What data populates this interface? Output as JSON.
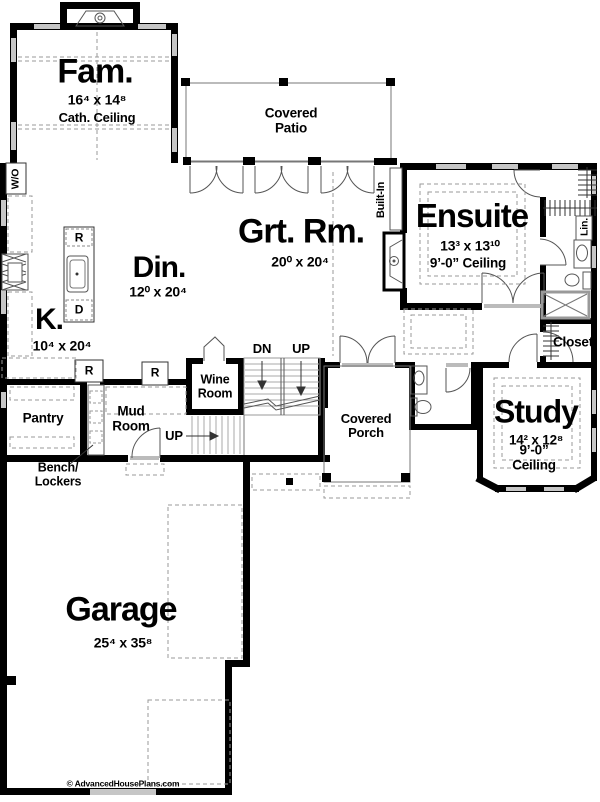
{
  "plan": {
    "title": "First Floor Plan",
    "rooms": {
      "fam": {
        "name": "Fam.",
        "dims": "16⁴ x 14⁸",
        "note": "Cath. Ceiling"
      },
      "covered_patio": {
        "name": "Covered Patio"
      },
      "grt_rm": {
        "name": "Grt. Rm.",
        "dims": "20⁰ x 20⁴"
      },
      "ensuite": {
        "name": "Ensuite",
        "dims": "13³ x 13¹⁰",
        "note": "9’-0” Ceiling"
      },
      "din": {
        "name": "Din.",
        "dims": "12⁰ x 20⁴"
      },
      "kitchen": {
        "name": "K.",
        "dims": "10⁴ x 20⁴"
      },
      "wine_room": {
        "name": "Wine Room"
      },
      "pantry": {
        "name": "Pantry"
      },
      "mud_room": {
        "name": "Mud Room"
      },
      "bench_lockers": {
        "name": "Bench/ Lockers"
      },
      "covered_porch": {
        "name": "Covered Porch"
      },
      "study": {
        "name": "Study",
        "dims": "14² x 12⁸",
        "note": "9’-0” Ceiling"
      },
      "closet": {
        "name": "Closet"
      },
      "garage": {
        "name": "Garage",
        "dims": "25⁴ x 35⁸"
      }
    },
    "annotations": {
      "wall_oven": "W/O",
      "built_in": "Built-In",
      "linen": "Lin.",
      "down": "DN",
      "up_stairs": "UP",
      "up_lower": "UP",
      "island_r": "R",
      "island_d": "D",
      "fridge_r": "R",
      "counter_r": "R",
      "copyright": "© AdvancedHousePlans.com"
    },
    "colors": {
      "wall": "#000000",
      "window_fill": "#c6c6c6",
      "dashed": "#999999"
    }
  }
}
